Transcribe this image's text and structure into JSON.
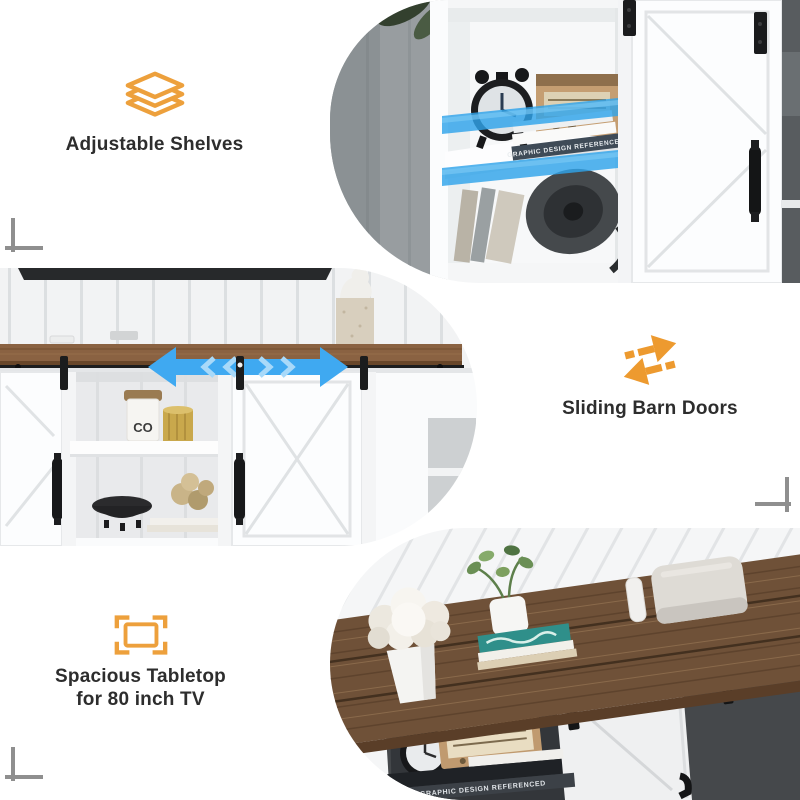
{
  "colors": {
    "accent_orange": "#EDA03C",
    "highlight_blue": "#3FA9F1",
    "caption_text": "#2D2D2D",
    "wood_brown": "#6F5138",
    "crop_mark_gray": "#8F8F8F"
  },
  "features": [
    {
      "icon": "stacked-shelves-icon",
      "label": "Adjustable Shelves"
    },
    {
      "icon": "sliding-arrows-icon",
      "label": "Sliding Barn Doors"
    },
    {
      "icon": "tabletop-size-icon",
      "label_line1": "Spacious Tabletop",
      "label_line2": "for 80 inch TV"
    }
  ],
  "photos": {
    "shelves_closeup": {
      "shelf_highlight_color": "#2FA3EA",
      "book_spine_text": "GRAPHIC DESIGN REFERENCED"
    },
    "sliding_doors_front": {
      "arrow_color": "#3FA9F1",
      "canister_label": "CO"
    },
    "tabletop_overview": {
      "book_spine_text": "GRAPHIC DESIGN REFERENCED"
    }
  }
}
